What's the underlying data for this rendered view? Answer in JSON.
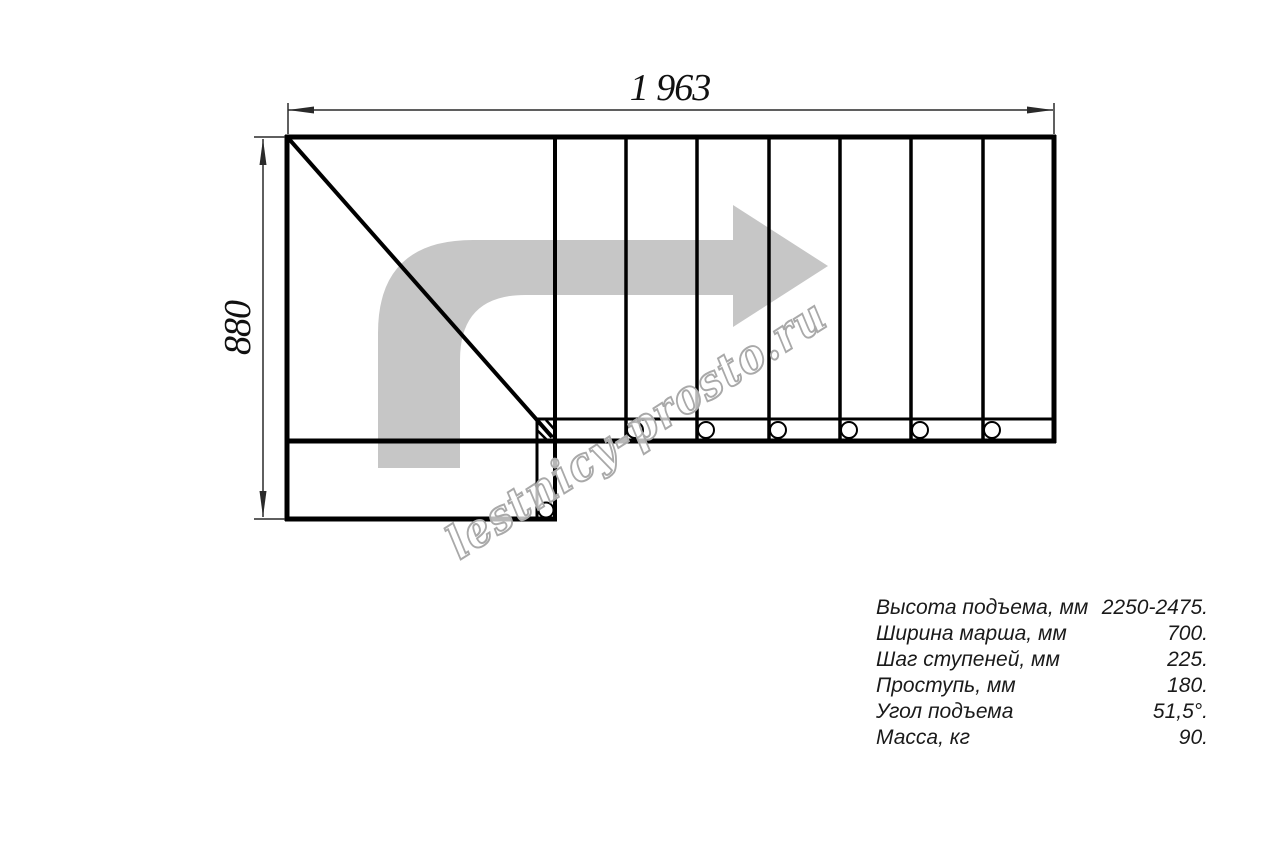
{
  "colors": {
    "line": "#000000",
    "dim": "#2a2a2a",
    "arrow": "#c6c6c6",
    "watermark_outline": "#a9a9a9",
    "table_text": "#1a1a1a",
    "bg": "#ffffff"
  },
  "drawing": {
    "top_dimension_label": "1 963",
    "left_dimension_label": "880",
    "watermark_text": "lestnicy-prosto.ru"
  },
  "specs": {
    "rows": [
      {
        "label": "Высота подъема, мм",
        "value": "2250-2475."
      },
      {
        "label": "Ширина марша, мм",
        "value": "700."
      },
      {
        "label": "Шаг ступеней, мм",
        "value": "225."
      },
      {
        "label": "Проступь, мм",
        "value": "180."
      },
      {
        "label": "Угол подъема",
        "value": "51,5°."
      },
      {
        "label": "Масса, кг",
        "value": "90."
      }
    ]
  }
}
